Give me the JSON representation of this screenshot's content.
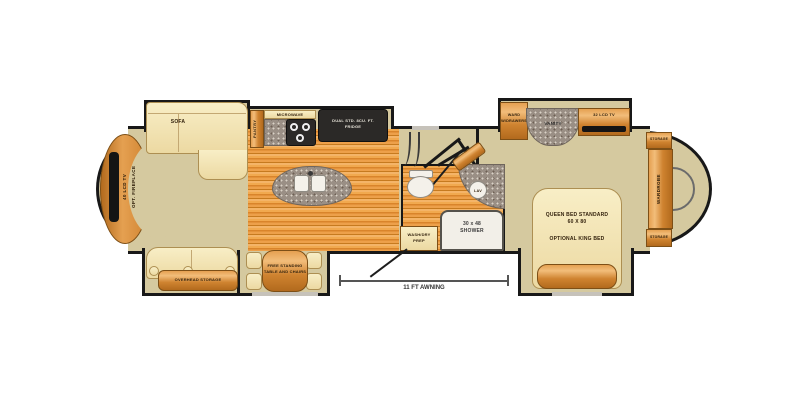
{
  "colors": {
    "wall": "#181818",
    "floor_tan": "#d5c99f",
    "wood_floor_base": "#e09a44",
    "cabinet_wood": "#cf8330",
    "counter_gray": "#9a8f85",
    "furniture_cream": "#f4e6ba",
    "appliance_dark": "#2b2927",
    "window_gray": "#c6c2ba",
    "label_text": "#33220d"
  },
  "labels": {
    "front_tv": "40 LCD TV",
    "front_fireplace": "OPT. FIREPLACE",
    "sofa": "SOFA",
    "pantry": "PANTRY",
    "microwave": "MICROWAVE",
    "fridge_line1": "DUAL STD. 8CU. FT.",
    "fridge_line2": "FRIDGE",
    "overhead_storage": "OVERHEAD STORAGE",
    "dinette_line1": "FREE STANDING",
    "dinette_line2": "TABLE AND CHAIRS",
    "shower_line1": "30 x 48",
    "shower_line2": "SHOWER",
    "lav": "LAV",
    "washdry_line1": "WASH/DRY",
    "washdry_line2": "PREP",
    "ward_line1": "WARD",
    "ward_line2": "W/DRAWERS",
    "vanity": "VANITY",
    "bedroom_tv": "32 LCD TV",
    "bed_line1": "QUEEN BED STANDARD",
    "bed_line2": "60 X 80",
    "bed_line3": "OPTIONAL KING BED",
    "storage_top": "STORAGE",
    "wardrobe": "WARDROBE",
    "storage_bottom": "STORAGE",
    "awning": "11 FT AWNING"
  }
}
